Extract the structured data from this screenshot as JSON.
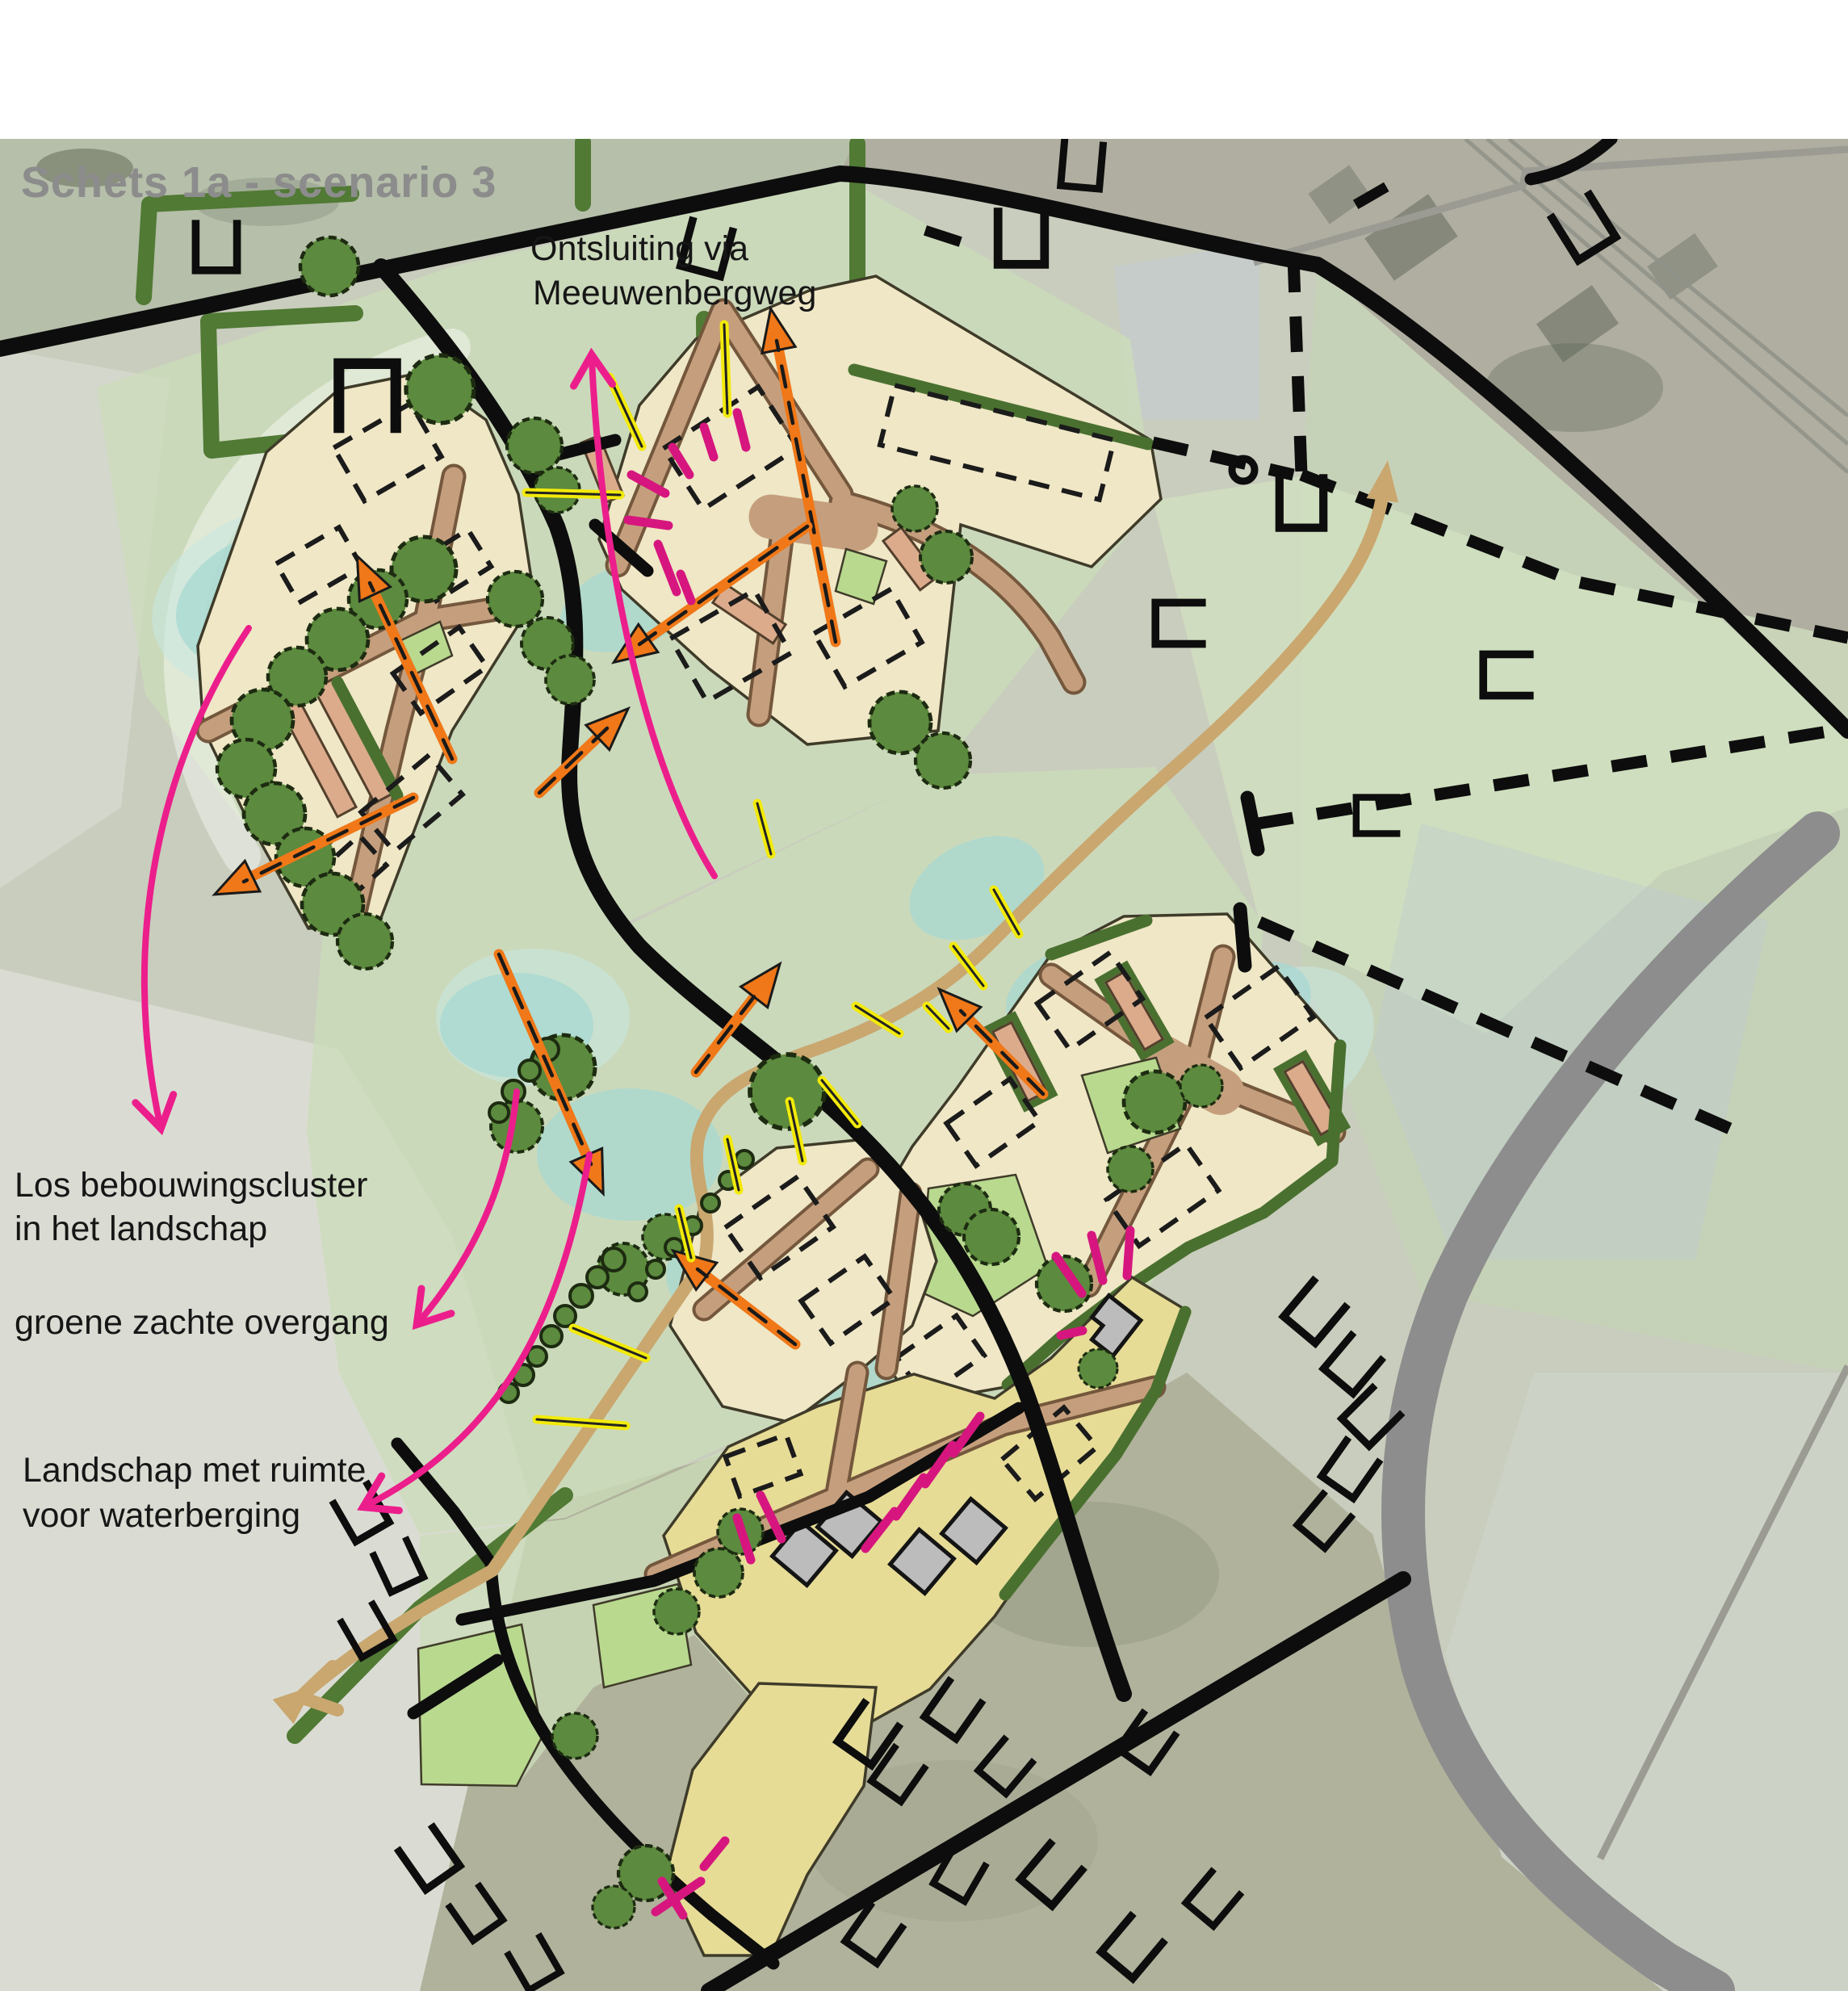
{
  "title": "Schets 1a - scenario 3",
  "annotations": {
    "ontsluiting": {
      "line1": "Ontsluiting via",
      "line2": "Meeuwenbergweg"
    },
    "cluster": {
      "line1": "Los bebouwingscluster",
      "line2": "in het landschap"
    },
    "overgang": {
      "line1": "groene zachte overgang"
    },
    "waterberging": {
      "line1": "Landschap met ruimte",
      "line2": "voor waterberging"
    }
  },
  "map": {
    "type": "urban-planning-sketch-over-aerial-photo",
    "features": {
      "orange_dashed_arrows": "new access / circulation directions",
      "pink_curved_arrows": "annotation pointers",
      "magenta_ticks": "edge accents along building clusters",
      "yellow_ticks": "landscape accents along brook zone",
      "tan_route": "landscape route with arrowheads both ends",
      "black_lines": "existing roads",
      "black_dashed_lines": "plot boundaries",
      "gray_band": "existing curved road",
      "cream_parcels": "new building clusters",
      "dashed_rectangles": "indicative building footprints",
      "green_blobs": "trees and hedges",
      "teal_patches": "water storage / brook"
    }
  },
  "colors": {
    "title_gray": "#8c8c8c",
    "annotation_black": "#161616",
    "parcel_cream": "#efe7c6",
    "parcel_yellow": "#e7dc96",
    "court_green": "#b9d98f",
    "road_brown": "#c59f7d",
    "strip_salmon": "#dcab8c",
    "tree_green": "#5c8a3e",
    "hedge_green": "#4a7030",
    "wash_green": "#ccdcba",
    "water_teal": "#a5d8d2",
    "road_black": "#0d0d0d",
    "road_gray": "#8d8d8d",
    "arrow_orange": "#f07818",
    "tick_yellow": "#f2ea0a",
    "tick_magenta": "#d6167e",
    "arrow_pink": "#ec1e8c",
    "route_tan": "#c9a76f"
  }
}
